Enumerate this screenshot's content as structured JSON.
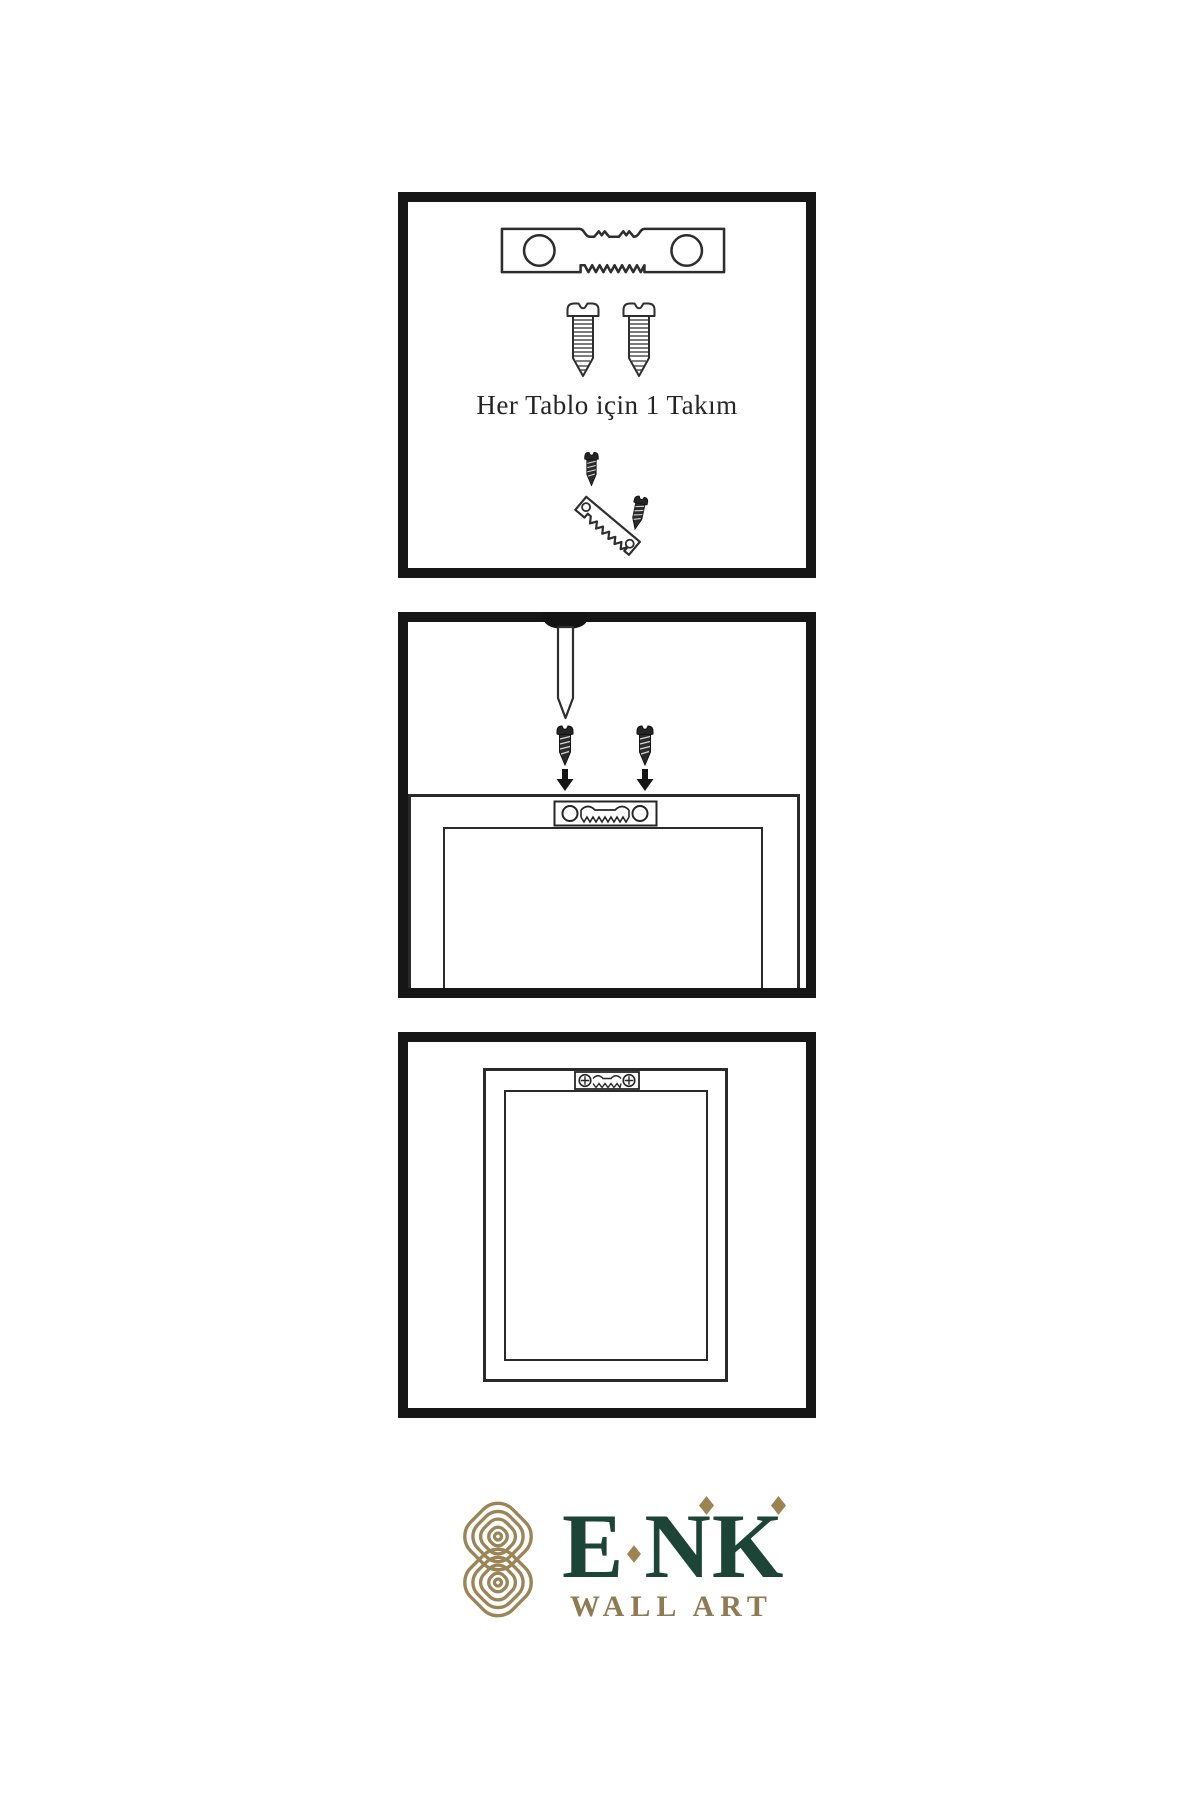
{
  "colors": {
    "background": "#ffffff",
    "panel_border": "#161616",
    "line_art": "#2e2e2e",
    "brand_green": "#1d4537",
    "brand_gold": "#9b8557"
  },
  "steps": [
    {
      "caption": "Her Tablo için 1 Takım",
      "icons": [
        "sawtooth-hanger-icon",
        "screw-icon",
        "screw-icon",
        "small-screw-icon",
        "tilted-sawtooth-hanger-icon",
        "small-screw-icon"
      ]
    },
    {
      "caption": "",
      "icons": [
        "nail-icon",
        "small-screw-icon",
        "small-screw-icon",
        "arrow-down-icon",
        "arrow-down-icon",
        "frame-back-icon",
        "sawtooth-hanger-plate-icon"
      ]
    },
    {
      "caption": "",
      "icons": [
        "frame-back-icon",
        "mounted-sawtooth-hanger-icon"
      ]
    }
  ],
  "brand": {
    "letters": [
      "E",
      "N",
      "K"
    ],
    "name": "ENK",
    "subtitle": "WALL ART"
  }
}
